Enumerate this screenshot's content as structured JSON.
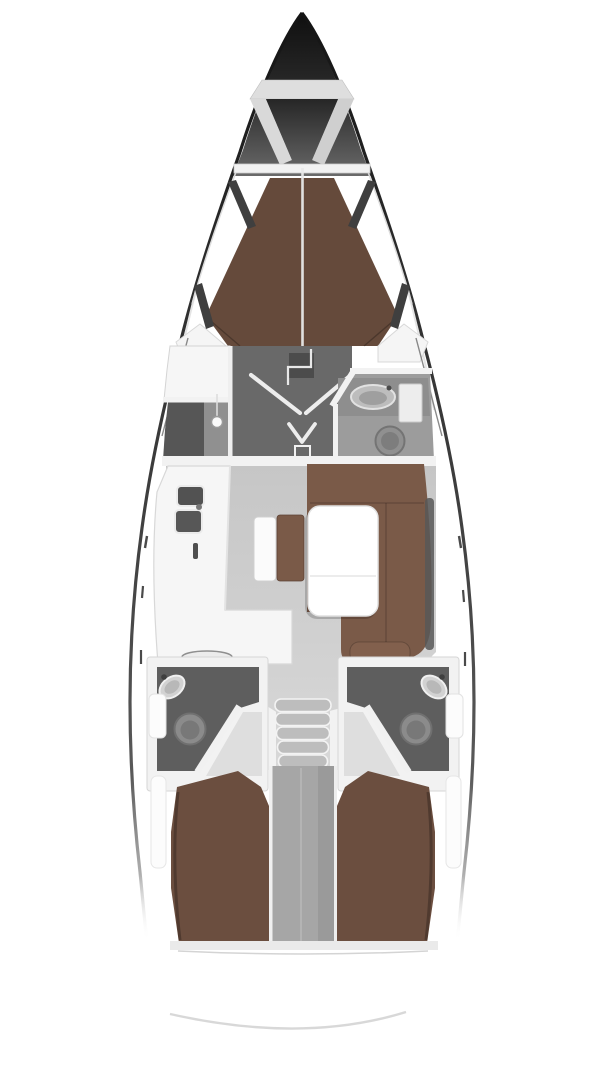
{
  "meta": {
    "diagram_type": "sailing-yacht-interior-floor-plan",
    "view": "top-down",
    "visible_text": ""
  },
  "colors": {
    "background": "#ffffff",
    "hullDark": "#1c1c1c",
    "bowTop": "#101010",
    "bowBottom": "#6a6a6a",
    "deckWhite": "#ffffff",
    "lockerGray": "#dedede",
    "beamWhite": "#f2f2f2",
    "vberthBrown": "#654a3b",
    "berthBrown": "#6b4e3f",
    "setteeBrown": "#7a5a48",
    "cushionBrown": "#82604d",
    "salonFloor": "#cbcbcb",
    "walkwayFloor": "#d6d6d6",
    "vestibuleGray": "#696969",
    "showerDark": "#565656",
    "showerLight": "#909090",
    "headRoomGray": "#9c9c9c",
    "counterGray": "#8e8e8e",
    "roomDark": "#5e5e5e",
    "wallWhite": "#f2f2f2",
    "counterWhite": "#f6f6f6",
    "tableWhite": "#ffffff",
    "sinkDark": "#525252",
    "fixtureGray": "#8b8b8b",
    "engineBay": "#a6a6a6",
    "stepGray": "#c6c6c6",
    "windowSlit": "#3f3f3f",
    "sternArc": "#d6d6d6",
    "lightPanel": "#dedede"
  },
  "features": {
    "bow": "anchor-locker",
    "forward_cabin": "v-berth-double",
    "forward_head_port": "shower-stall",
    "forward_head_starboard": "wc-with-sink",
    "salon_port": "l-shaped-galley-double-sink",
    "salon_center": "bench-seat",
    "salon_starboard": "u-settee-with-table",
    "companionway": "steps",
    "aft_head_port": "wc-with-sink",
    "aft_head_starboard": "wc-with-sink",
    "aft_cabin_port": "double-berth",
    "aft_cabin_starboard": "double-berth",
    "stern": "swim-platform-arc"
  }
}
